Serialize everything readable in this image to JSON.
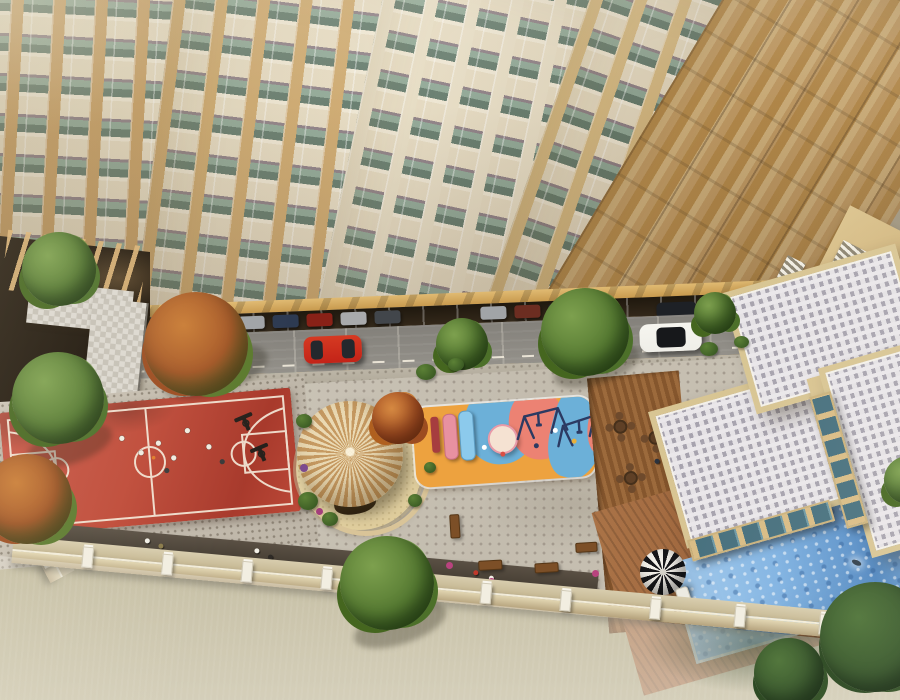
{
  "scene": {
    "type": "architectural-aerial-render",
    "description": "Top-down drone view of a residential high-rise podium with outdoor amenity deck",
    "time_of_day": "day",
    "areas": [
      "tower-facade",
      "driveway-with-cars",
      "basketball-court",
      "gazebo-plaza",
      "kids-playground",
      "lawn-with-benches",
      "cafe-deck",
      "clubhouse-roofs",
      "swimming-pool",
      "boundary-wall",
      "scrubland"
    ]
  },
  "objects": {
    "vehicles": {
      "on_road": [
        "red-hatchback",
        "white-suv-black-roof"
      ],
      "parked_in_shade_count": 10
    },
    "basketball_court": {
      "surface": "red",
      "players_count": 8,
      "hoops_count": 2
    },
    "gazebo": {
      "roof": "conical-wood-slats",
      "base": "sand-circle"
    },
    "playground": {
      "ground_colors": [
        "orange",
        "blue",
        "coral"
      ],
      "equipment": [
        "pink-slide",
        "blue-slide",
        "climb-panel",
        "dome",
        "swing-set"
      ],
      "kids_count": 5
    },
    "lawn": {
      "benches_count": 5
    },
    "cafe_deck": {
      "tables_count": 4
    },
    "pool": {
      "swimmers_count": 1,
      "umbrella": "black-white-striped",
      "loungers_count": 2
    },
    "boundary": {
      "posts_count": 13
    },
    "trees_count": 12
  },
  "palette": {
    "facade_spandrel": "#e7dcc2",
    "facade_glass": "#8fa896",
    "facade_glass_dark": "#637a6b",
    "facade_ledge": "#8d7f85",
    "canopy_tan": "#e0ba72",
    "shade_band": "#33281a",
    "road_grey": "#94918a",
    "road_dash": "#e9e3d5",
    "sidewalk_grey": "#bcb5a6",
    "paving_grey": "#d2ccc0",
    "paving_dot": "#a59c90",
    "court_red": "#bf4a38",
    "court_red_dark": "#a83a2c",
    "court_line": "#f3e9d8",
    "sand": "#e6d4a4",
    "roof_slat_light": "#ead9b3",
    "roof_slat_dark": "#c69a62",
    "grass_green": "#577a36",
    "grass_green_dark": "#49692c",
    "play_orange": "#eda23f",
    "play_blue": "#6cb0d8",
    "play_coral": "#ec8273",
    "slide_pink": "#e891a0",
    "slide_blue": "#8ccaec",
    "swing_navy": "#2c3a62",
    "deck_wood": "#9c6a3c",
    "deck_wood_dark": "#85562d",
    "pooldeck_wood": "#9a6038",
    "roof_tile_light": "#e5e2e5",
    "roof_tile_dark": "#a7a3ae",
    "parapet_beige": "#d8c593",
    "wall_beige": "#d9bc85",
    "glass_teal": "#47707e",
    "pool_light": "#aed2f0",
    "pool_mid": "#7fb2e2",
    "pool_deep": "#4f87c2",
    "umbrella_dark": "#17171a",
    "umbrella_light": "#f2efe8",
    "wall_tan": "#b3a07a",
    "post_white": "#f2eee1",
    "ledge_dark": "#3d362c",
    "scrub_base": "#a69d78",
    "tree_green": "#567a32",
    "tree_green_dark": "#3e5c24",
    "tree_dark": "#2f4f23",
    "tree_rust": "#ad5526",
    "tree_rust_light": "#c97c35",
    "car_red": "#c32318",
    "suv_white": "#efeee8",
    "suv_roof": "#17181b"
  }
}
